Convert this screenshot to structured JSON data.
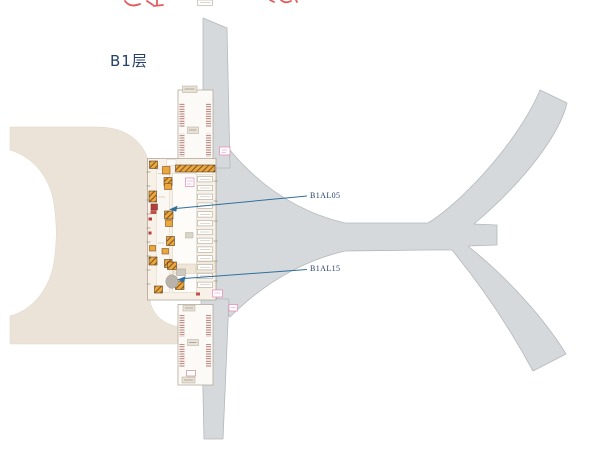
{
  "floor": {
    "label": "B1层"
  },
  "callouts": [
    {
      "label": "B1AL05"
    },
    {
      "label": "B1AL15"
    }
  ],
  "colors": {
    "landside_fill": "#ece3d8",
    "airside_fill": "#d6d9db",
    "airside_border": "#b4b8ba",
    "core_fill": "#f7f1e8",
    "core_border": "#a79d8e",
    "escalator_orange": "#eca63b",
    "hatch_brown": "#6e4a22",
    "callout_line": "#2f6f9e",
    "label_navy": "#27406a",
    "clipped_red": "#e25c5c",
    "pink_accent": "#e583b6"
  }
}
